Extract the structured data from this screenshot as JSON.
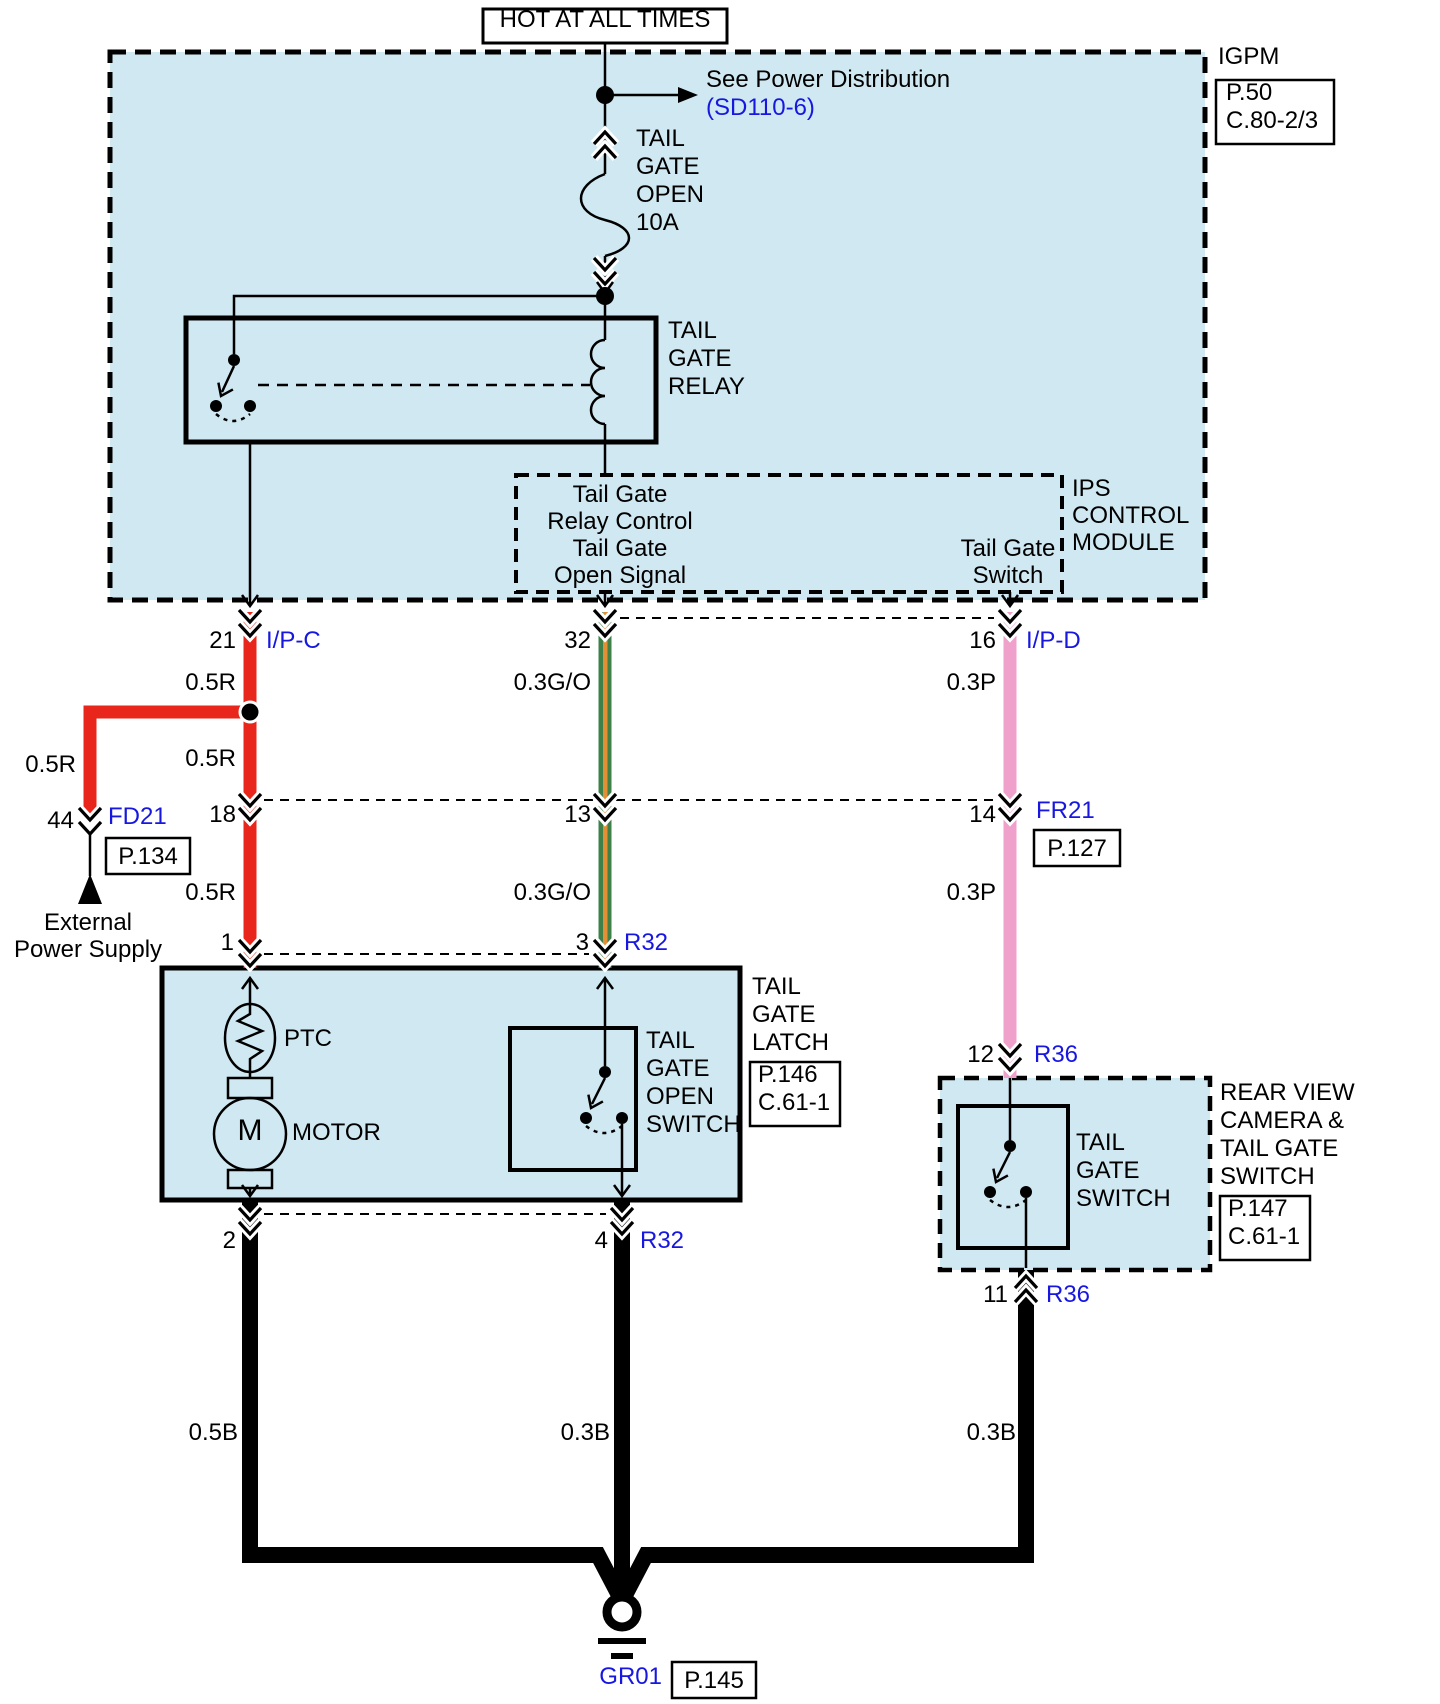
{
  "header": {
    "hot_label": "HOT AT ALL TIMES",
    "see_power": "See Power Distribution",
    "see_power_ref": "(SD110-6)",
    "fuse_label": [
      "TAIL",
      "GATE",
      "OPEN",
      "10A"
    ]
  },
  "igpm": {
    "title": "IGPM",
    "page": "P.50",
    "connector": "C.80-2/3",
    "relay_label": [
      "TAIL",
      "GATE",
      "RELAY"
    ]
  },
  "ips": {
    "title": [
      "IPS",
      "CONTROL",
      "MODULE"
    ],
    "relay_control": [
      "Tail Gate",
      "Relay Control"
    ],
    "open_signal": [
      "Tail Gate",
      "Open Signal"
    ],
    "switch": [
      "Tail Gate",
      "Switch"
    ]
  },
  "pins": {
    "p21": "21",
    "p32": "32",
    "p16": "16",
    "p18": "18",
    "p13": "13",
    "p14": "14",
    "p44": "44",
    "p1": "1",
    "p3": "3",
    "p12": "12",
    "p2": "2",
    "p4": "4",
    "p11": "11"
  },
  "connectors": {
    "ipc": "I/P-C",
    "ipd": "I/P-D",
    "fd21": "FD21",
    "fd21_page": "P.134",
    "fr21": "FR21",
    "fr21_page": "P.127",
    "r32": "R32",
    "r36": "R36",
    "gr01": "GR01",
    "gr01_page": "P.145"
  },
  "wire_labels": {
    "r05": "0.5R",
    "go03": "0.3G/O",
    "p03": "0.3P",
    "b05": "0.5B",
    "b03": "0.3B"
  },
  "external_supply": [
    "External",
    "Power Supply"
  ],
  "latch": {
    "ptc": "PTC",
    "motor_letter": "M",
    "motor": "MOTOR",
    "switch_label": [
      "TAIL",
      "GATE",
      "OPEN",
      "SWITCH"
    ],
    "title": [
      "TAIL",
      "GATE",
      "LATCH"
    ],
    "page": "P.146",
    "connector": "C.61-1"
  },
  "rear_camera": {
    "switch_label": [
      "TAIL",
      "GATE",
      "SWITCH"
    ],
    "title": [
      "REAR VIEW",
      "CAMERA &",
      "TAIL GATE",
      "SWITCH"
    ],
    "page": "P.147",
    "connector": "C.61-1"
  },
  "colors": {
    "module_fill": "#cfe8f1",
    "wire_red": "#e8261b",
    "wire_green": "#3e8048",
    "wire_orange": "#e28f35",
    "wire_pink": "#efa0cb",
    "ref_blue": "#1717e0",
    "line_black": "#000000"
  }
}
